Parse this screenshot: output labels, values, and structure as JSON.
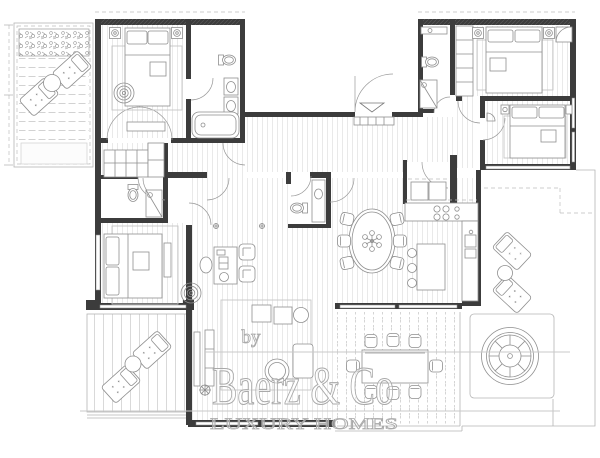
{
  "watermark": {
    "prefix": "by",
    "brand": "Baerz & Co",
    "tagline": "LUXURY HOMES"
  },
  "palette": {
    "wall": "#3c3c3c",
    "furniture_line": "#8f8f8f",
    "floor_hatch": "#d2d2d2",
    "terrace_line": "#b8b8b8",
    "watermark": "#a9a9a9",
    "background": "#ffffff"
  },
  "plan": {
    "type": "apartment-floor-plan",
    "areas": [
      "terrace-northwest",
      "bedroom-northwest",
      "ensuite-bathroom",
      "hallway-wardrobe",
      "wc",
      "bedroom-west",
      "living-room",
      "dining-area",
      "powder-room",
      "kitchen",
      "utility-room",
      "entrance-hall",
      "bathroom-north",
      "bedroom-northeast",
      "bedroom-east",
      "terrace-southwest",
      "terrace-south",
      "terrace-east",
      "jacuzzi"
    ]
  }
}
